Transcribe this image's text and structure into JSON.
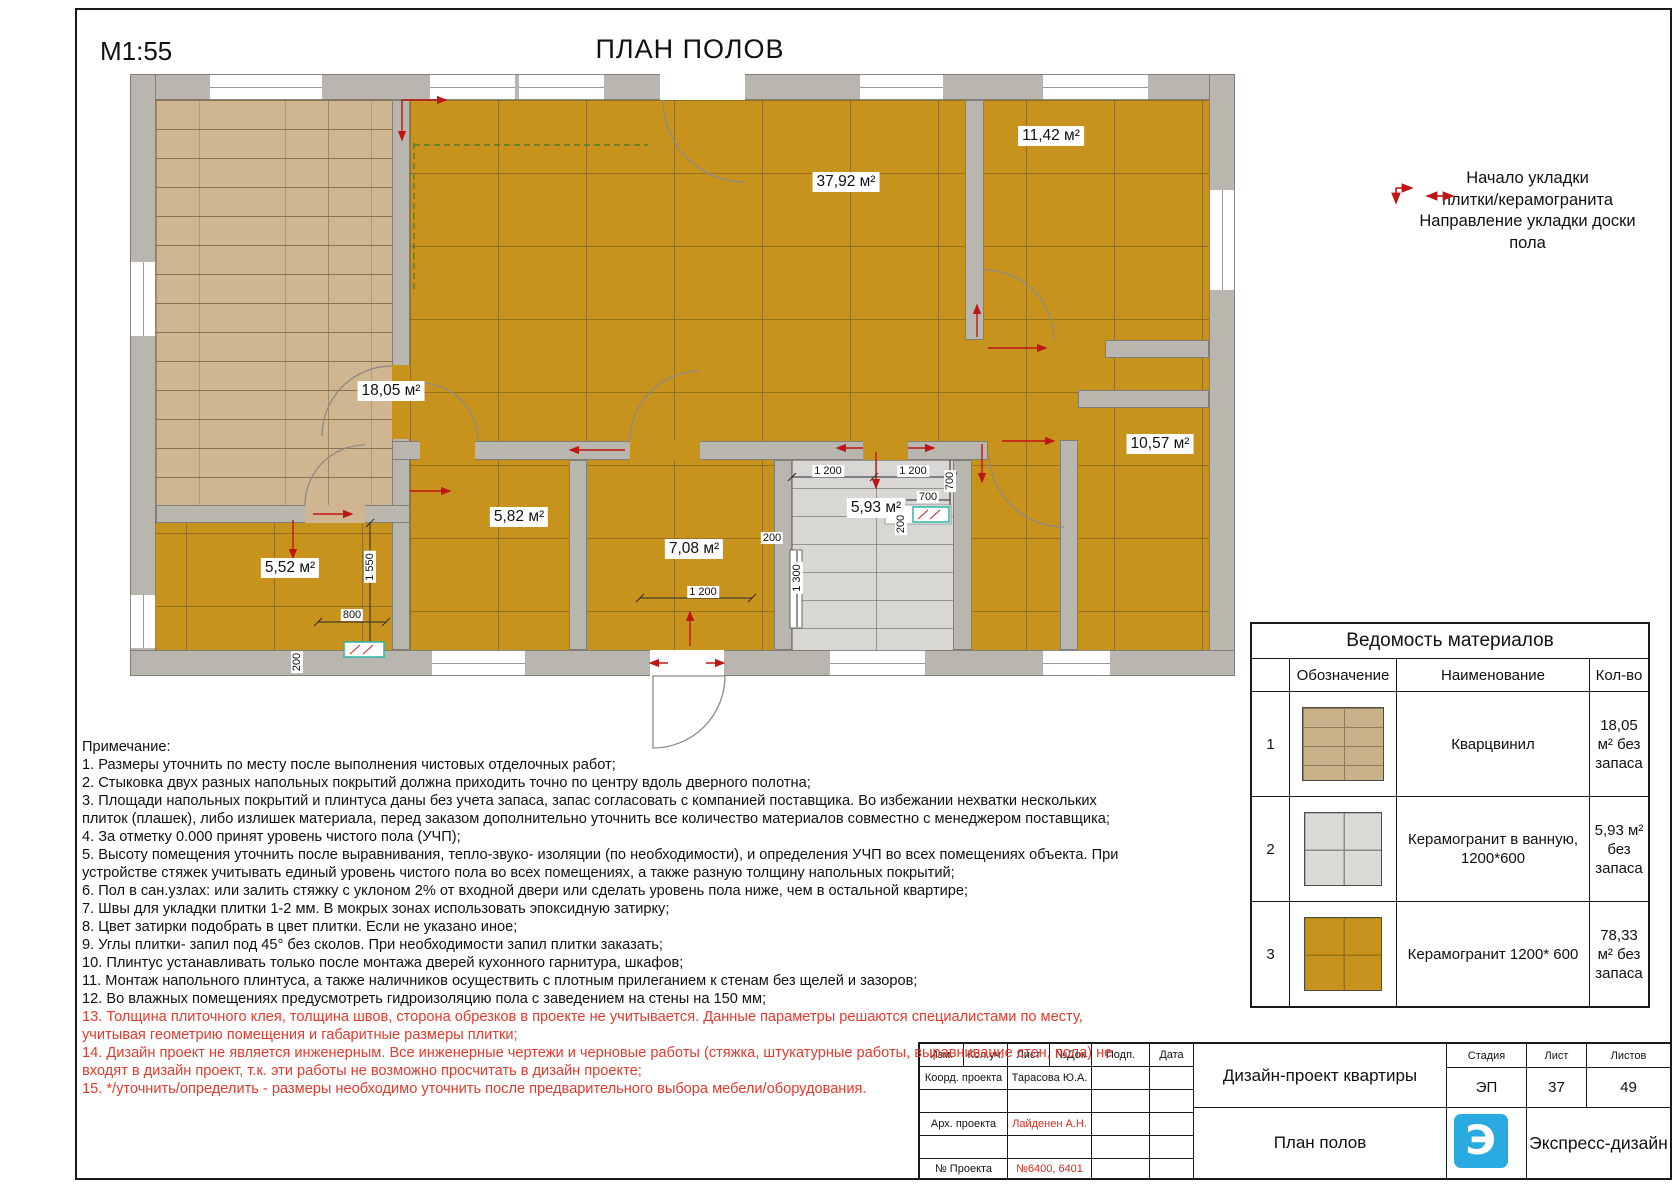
{
  "sheet": {
    "scale": "М1:55",
    "title": "ПЛАН ПОЛОВ"
  },
  "legend": {
    "line1": "Начало укладки",
    "line2": "плитки/керамогранита",
    "line3": "Направление укладки доски",
    "line4": "пола",
    "icons": [
      "tile-start-corner-arrow-icon",
      "plank-direction-double-arrow-icon"
    ]
  },
  "rooms": {
    "wood": {
      "area": "18,05 м²",
      "covering": "кварцвинил"
    },
    "living": {
      "area": "37,92 м²",
      "covering": "керамогранит"
    },
    "r1142": {
      "area": "11,42 м²",
      "covering": "керамогранит"
    },
    "r1057": {
      "area": "10,57 м²",
      "covering": "керамогранит"
    },
    "r552": {
      "area": "5,52 м²",
      "covering": "керамогранит"
    },
    "r582": {
      "area": "5,82 м²",
      "covering": "керамогранит"
    },
    "r708": {
      "area": "7,08 м²",
      "covering": "керамогранит"
    },
    "bath": {
      "area": "5,93 м²",
      "covering": "керамогранит в ванную"
    }
  },
  "dims": {
    "bath_a": "1 200",
    "bath_b": "1 200",
    "v700": "700",
    "h700": "700",
    "v200": "200",
    "h200": "200",
    "v1300": "1 300",
    "room708": "1 200",
    "v1550": "1 550",
    "d800": "800",
    "v200b": "200"
  },
  "materials_table": {
    "title": "Ведомость материалов",
    "headers": {
      "mark": "Обозначение",
      "name": "Наименование",
      "qty": "Кол-во"
    },
    "rows": [
      {
        "num": "1",
        "swatch": "sw-wood",
        "swatch_name": "quartzvinyl-plank-swatch",
        "name": "Кварцвинил",
        "qty": "18,05 м² без запаса"
      },
      {
        "num": "2",
        "swatch": "sw-gray",
        "swatch_name": "bathroom-porcelain-swatch",
        "name": "Керамогранит в ванную, 1200*600",
        "qty": "5,93 м² без запаса"
      },
      {
        "num": "3",
        "swatch": "sw-orange",
        "swatch_name": "porcelain-1200x600-swatch",
        "name": "Керамогранит 1200* 600",
        "qty": "78,33 м² без запаса"
      }
    ]
  },
  "notes": {
    "heading": "Примечание:",
    "items": [
      {
        "red": false,
        "text": "1. Размеры уточнить по месту после выполнения чистовых отделочных работ;"
      },
      {
        "red": false,
        "text": "2. Стыковка двух разных напольных покрытий должна приходить точно по центру вдоль дверного полотна;"
      },
      {
        "red": false,
        "text": "3. Площади напольных покрытий и плинтуса даны без учета запаса, запас согласовать с компанией поставщика. Во избежании нехватки нескольких плиток (плашек), либо излишек материала, перед заказом дополнительно уточнить все количество материалов совместно с менеджером поставщика;"
      },
      {
        "red": false,
        "text": "4. За отметку 0.000 принят  уровень чистого пола (УЧП);"
      },
      {
        "red": false,
        "text": "5. Высоту помещения уточнить после выравнивания, тепло-звуко- изоляции (по необходимости), и определения УЧП во всех помещениях объекта. При устройстве стяжек учитывать единый уровень чистого пола во всех помещениях, а также разную толщину напольных покрытий;"
      },
      {
        "red": false,
        "text": "6. Пол в сан.узлах: или залить стяжку с уклоном 2% от входной двери или сделать уровень пола ниже, чем в остальной квартире;"
      },
      {
        "red": false,
        "text": "7. Швы для укладки плитки 1-2 мм. В мокрых зонах использовать эпоксидную затирку;"
      },
      {
        "red": false,
        "text": "8. Цвет затирки подобрать в цвет плитки. Если не указано иное;"
      },
      {
        "red": false,
        "text": "9. Углы плитки- запил под 45° без сколов. При необходимости запил плитки заказать;"
      },
      {
        "red": false,
        "text": "10. Плинтус устанавливать только после монтажа дверей кухонного гарнитура, шкафов;"
      },
      {
        "red": false,
        "text": "11. Монтаж напольного плинтуса, а также наличников осуществить с плотным прилеганием к стенам без щелей и зазоров;"
      },
      {
        "red": false,
        "text": "12. Во влажных помещениях предусмотреть гидроизоляцию пола с заведением на стены на 150 мм;"
      },
      {
        "red": true,
        "text": "13. Толщина плиточного клея, толщина швов, сторона обрезков в проекте не учитывается. Данные параметры решаются специалистами по месту, учитывая геометрию помещения и габаритные размеры плитки;"
      },
      {
        "red": true,
        "text": "14. Дизайн проект не является инженерным. Все инженерные чертежи и черновые работы (стяжка, штукатурные работы, выравнивание стен, пола) не входят в дизайн проект, т.к. эти работы не возможно просчитать в дизайн проекте;"
      },
      {
        "red": true,
        "text": "15.  */уточнить/определить - размеры необходимо уточнить после предварительного выбора мебели/оборудования."
      }
    ]
  },
  "title_block": {
    "header_cols": [
      "Изм.",
      "Кол.уч.",
      "Лист",
      "№Док",
      "Подп.",
      "Дата"
    ],
    "row_coord": {
      "label": "Коорд. проекта",
      "value": "Тарасова Ю.А."
    },
    "row_arch": {
      "label": "Арх. проекта",
      "value": "Лайденен А.Н."
    },
    "row_num": {
      "label": "№ Проекта",
      "value": "№6400, 6401"
    },
    "project": "Дизайн-проект квартиры",
    "sheet_name": "План полов",
    "stage": {
      "label": "Стадия",
      "value": "ЭП"
    },
    "sheet": {
      "label": "Лист",
      "value": "37"
    },
    "sheets": {
      "label": "Листов",
      "value": "49"
    },
    "brand": "Экспресс-дизайн",
    "logo_letter": "Э"
  },
  "colors": {
    "porcelain_orange": "#c7931d",
    "quartzvinyl_wood": "#cfb590",
    "bath_gray": "#d8d7d3",
    "wall_gray": "#b9b6af",
    "accent_red": "#c01515",
    "note_red": "#e23b2e",
    "logo_blue": "#29abe2",
    "teal_fixture": "#2bb3a3"
  }
}
